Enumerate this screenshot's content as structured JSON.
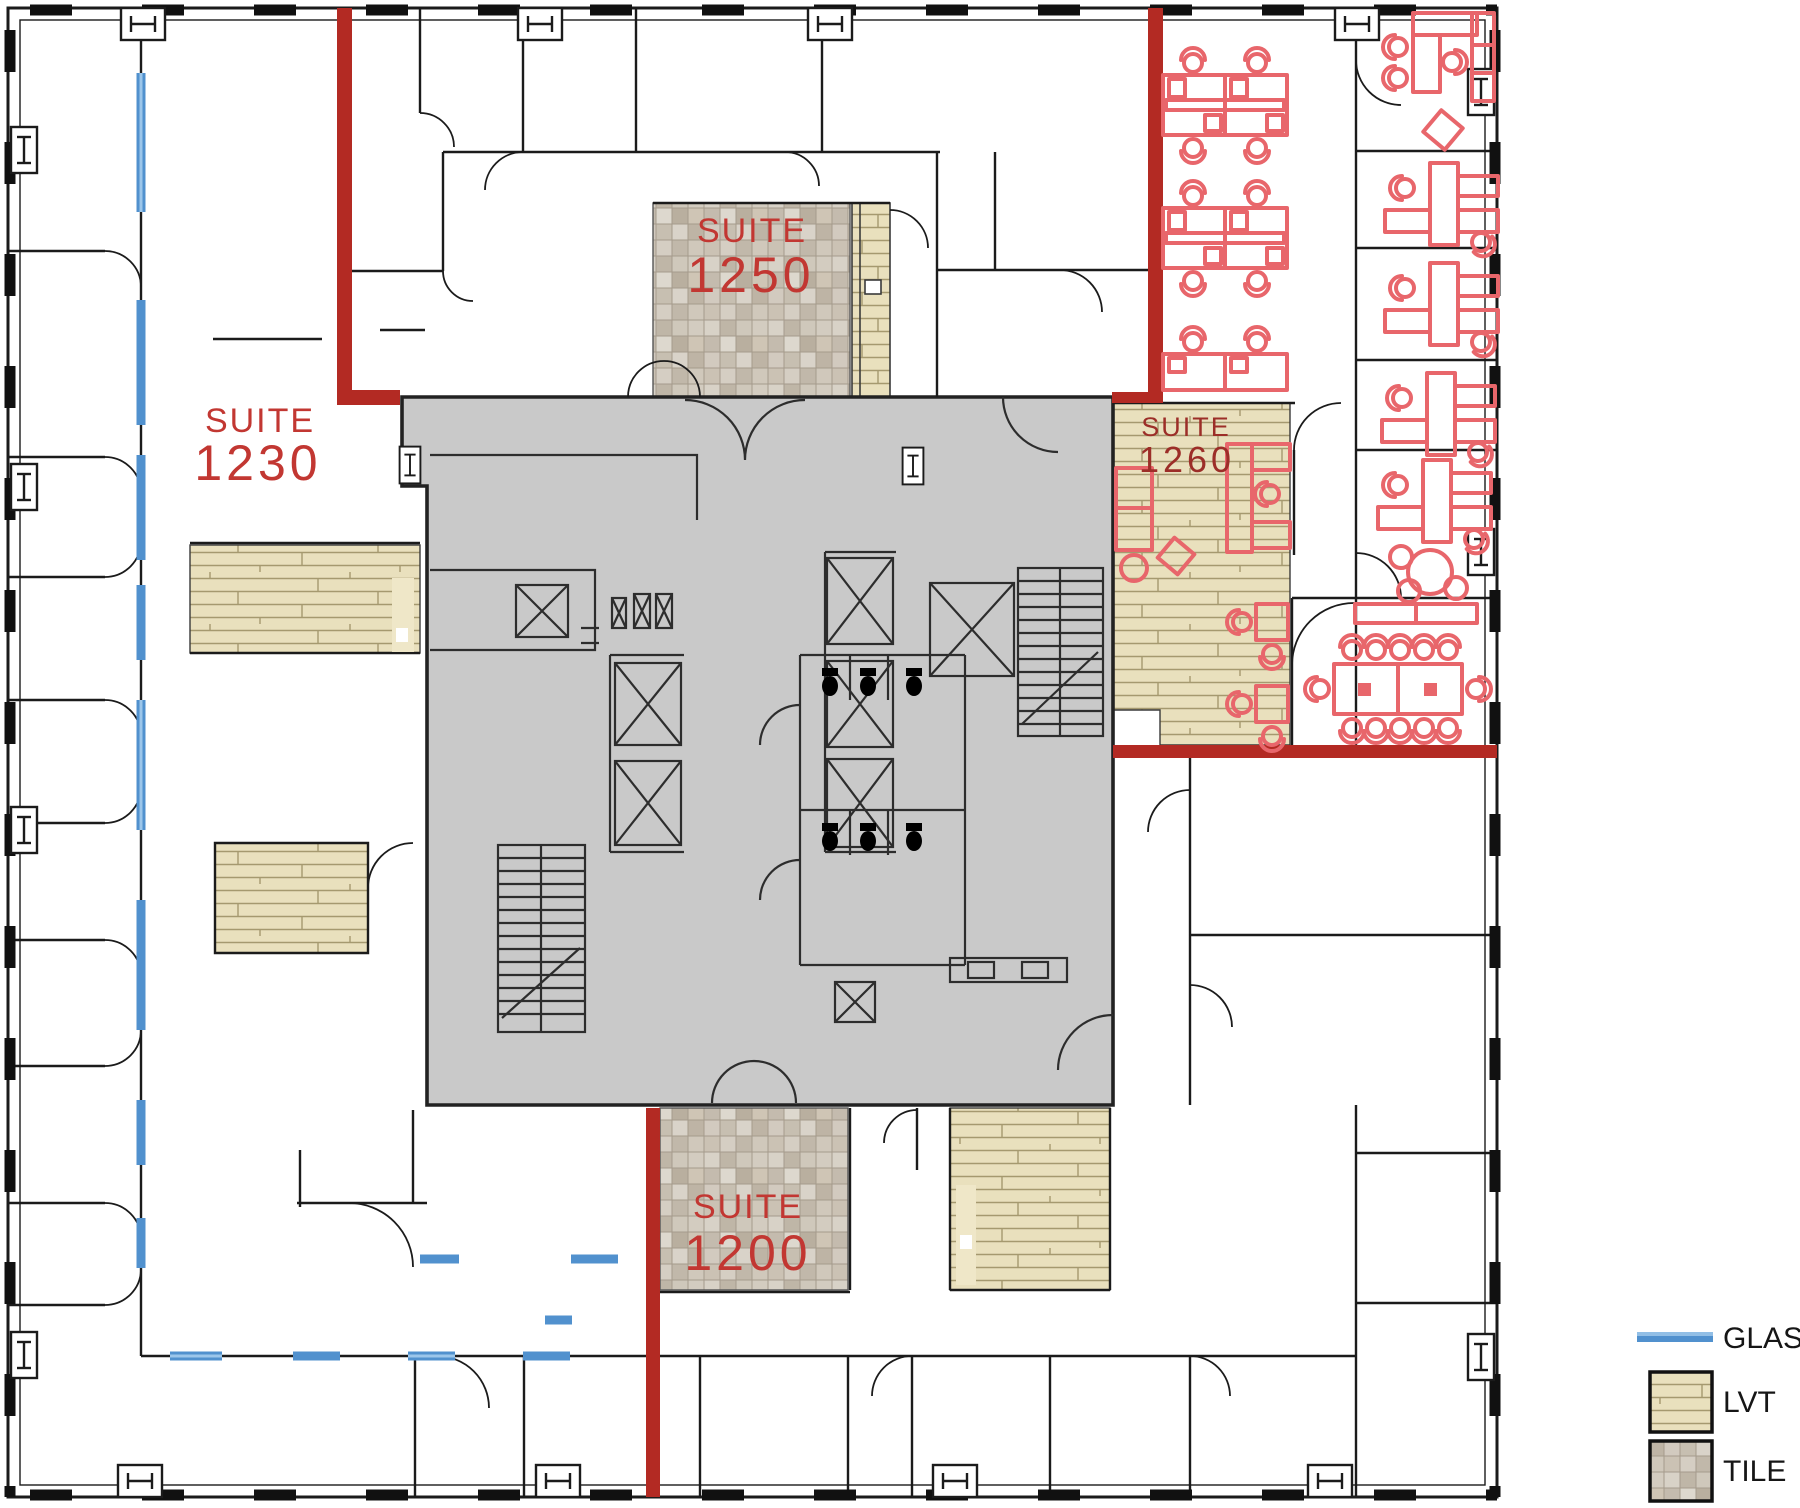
{
  "suites": {
    "s1230": {
      "name": "SUITE",
      "number": "1230"
    },
    "s1250": {
      "name": "SUITE",
      "number": "1250"
    },
    "s1200": {
      "name": "SUITE",
      "number": "1200"
    },
    "s1260": {
      "name": "SUITE",
      "number": "1260"
    }
  },
  "legend": {
    "items": [
      {
        "label": "GLASS",
        "swatch": "glass-line"
      },
      {
        "label": "LVT",
        "swatch": "lvt-swatch"
      },
      {
        "label": "TILE",
        "swatch": "tile-swatch"
      }
    ]
  },
  "colors": {
    "demising_wall_red": "#b32a23",
    "furniture_red": "#e8666b",
    "suite_label_red": "#c23732",
    "suite_1260_label_red": "#9c2e28",
    "glass_blue": "#5191ce",
    "glass_blue_light": "#92bfe6",
    "lvt_tan": "#e9e0bd",
    "tile_gray": "#c9c1b4",
    "core_gray": "#c9c9c9",
    "wall_black": "#1b1b1b"
  }
}
